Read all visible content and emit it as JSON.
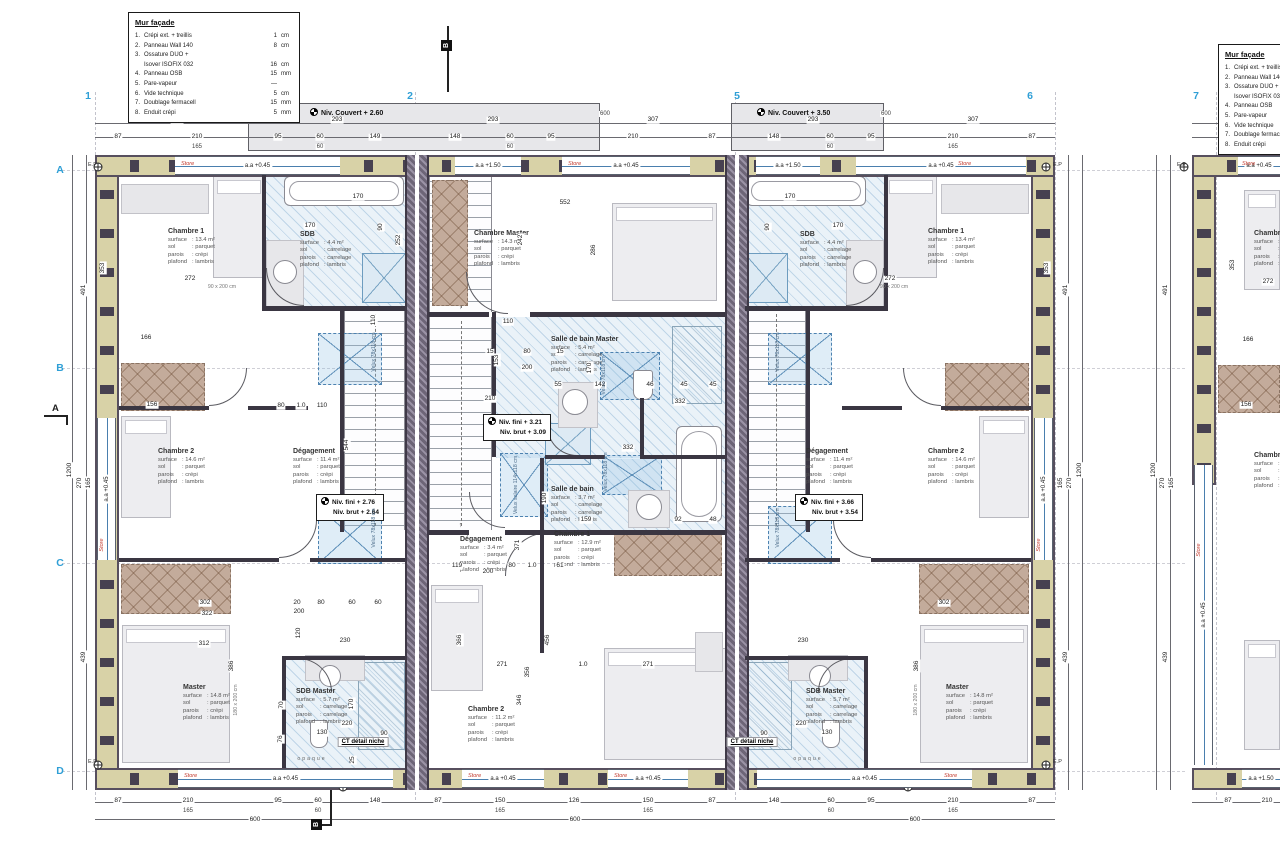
{
  "colors": {
    "grid_blue": "#2f9fd6",
    "store_red": "#c2382c",
    "wall_tan": "#d8d2a7",
    "party_gray": "#786f85",
    "bath_blue": "#eaf2f8",
    "dressing_brown": "#c3ab9b"
  },
  "legend": {
    "title": "Mur façade",
    "items": [
      {
        "n": "1.",
        "l": "Crépi ext. + treillis",
        "v": "1",
        "u": "cm"
      },
      {
        "n": "2.",
        "l": "Panneau Wall 140",
        "v": "8",
        "u": "cm"
      },
      {
        "n": "3.",
        "l": "Ossature DUO +",
        "l2": "Isover ISOFIX 032",
        "v": "16",
        "u": "cm"
      },
      {
        "n": "4.",
        "l": "Panneau OSB",
        "v": "15",
        "u": "mm"
      },
      {
        "n": "5.",
        "l": "Pare-vapeur",
        "v": "—",
        "u": ""
      },
      {
        "n": "6.",
        "l": "Vide technique",
        "v": "5",
        "u": "cm"
      },
      {
        "n": "7.",
        "l": "Doublage fermacell",
        "v": "15",
        "u": "mm"
      },
      {
        "n": "8.",
        "l": "Enduit crépi",
        "v": "5",
        "u": "mm"
      }
    ]
  },
  "grid": {
    "columns": [
      {
        "label": "1",
        "x": 88
      },
      {
        "label": "2",
        "x": 410
      },
      {
        "label": "5",
        "x": 737
      },
      {
        "label": "6",
        "x": 1030
      },
      {
        "label": "7",
        "x": 1196
      }
    ],
    "rows": [
      {
        "label": "A",
        "y": 170
      },
      {
        "label": "B",
        "y": 368
      },
      {
        "label": "C",
        "y": 563
      },
      {
        "label": "D",
        "y": 771
      }
    ]
  },
  "levels": {
    "bands": [
      {
        "label": "Niv. Couvert + 2.60",
        "x": 248,
        "y": 103,
        "w": 352,
        "h": 48,
        "lx": 62
      },
      {
        "label": "Niv. Couvert + 3.50",
        "x": 731,
        "y": 103,
        "w": 153,
        "h": 48,
        "lx": 26
      }
    ],
    "boxes": [
      {
        "l1": "Niv. fini + 2.76",
        "l2": "Niv. brut + 2.64",
        "x": 316,
        "y": 494
      },
      {
        "l1": "Niv. fini + 3.21",
        "l2": "Niv. brut + 3.09",
        "x": 483,
        "y": 414
      },
      {
        "l1": "Niv. fini + 3.66",
        "l2": "Niv. brut + 3.54",
        "x": 795,
        "y": 494
      }
    ]
  },
  "rooms": [
    {
      "id": "chambre1-left",
      "name": "Chambre 1",
      "x": 168,
      "y": 228,
      "surface": "13.4 m²",
      "sol": "parquet",
      "parois": "crépi",
      "plafond": "lambris"
    },
    {
      "id": "sdb-left",
      "name": "SDB",
      "x": 300,
      "y": 231,
      "surface": "4.4 m²",
      "sol": "carrelage",
      "parois": "carrelage",
      "plafond": "lambris"
    },
    {
      "id": "chambre2-left",
      "name": "Chambre 2",
      "x": 158,
      "y": 448,
      "surface": "14.6 m²",
      "sol": "parquet",
      "parois": "crépi",
      "plafond": "lambris"
    },
    {
      "id": "degagement-left",
      "name": "Dégagement",
      "x": 293,
      "y": 448,
      "surface": "11.4 m²",
      "sol": "parquet",
      "parois": "crépi",
      "plafond": "lambris"
    },
    {
      "id": "master-left",
      "name": "Master",
      "x": 183,
      "y": 684,
      "surface": "14.8 m²",
      "sol": "parquet",
      "parois": "crépi",
      "plafond": "lambris"
    },
    {
      "id": "sdb-master-left",
      "name": "SDB Master",
      "x": 296,
      "y": 688,
      "surface": "5.7 m²",
      "sol": "carrelage",
      "parois": "carrelage",
      "plafond": "lambris"
    },
    {
      "id": "chambre-master-center",
      "name": "Chambre Master",
      "x": 474,
      "y": 230,
      "surface": "14.3 m²",
      "sol": "parquet",
      "parois": "crépi",
      "plafond": "lambris"
    },
    {
      "id": "sdb-master-center",
      "name": "Salle de bain Master",
      "x": 551,
      "y": 336,
      "surface": "5.4 m²",
      "sol": "carrelage",
      "parois": "carrelage",
      "plafond": "lambris"
    },
    {
      "id": "sdb-center",
      "name": "Salle de bain",
      "x": 551,
      "y": 486,
      "surface": "3.7 m²",
      "sol": "carrelage",
      "parois": "carrelage",
      "plafond": "lambris"
    },
    {
      "id": "degagement-center",
      "name": "Dégagement",
      "x": 460,
      "y": 536,
      "surface": "3.4 m²",
      "sol": "parquet",
      "parois": "crépi",
      "plafond": "lambris"
    },
    {
      "id": "chambre1-center",
      "name": "Chambre 1",
      "x": 554,
      "y": 531,
      "surface": "12.9 m²",
      "sol": "parquet",
      "parois": "crépi",
      "plafond": "lambris"
    },
    {
      "id": "chambre2-center",
      "name": "Chambre 2",
      "x": 468,
      "y": 706,
      "surface": "11.2 m²",
      "sol": "parquet",
      "parois": "crépi",
      "plafond": "lambris"
    },
    {
      "id": "sdb-right",
      "name": "SDB",
      "x": 800,
      "y": 231,
      "surface": "4.4 m²",
      "sol": "carrelage",
      "parois": "carrelage",
      "plafond": "lambris"
    },
    {
      "id": "chambre1-right",
      "name": "Chambre 1",
      "x": 928,
      "y": 228,
      "surface": "13.4 m²",
      "sol": "parquet",
      "parois": "crépi",
      "plafond": "lambris"
    },
    {
      "id": "degagement-right",
      "name": "Dégagement",
      "x": 806,
      "y": 448,
      "surface": "11.4 m²",
      "sol": "parquet",
      "parois": "crépi",
      "plafond": "lambris"
    },
    {
      "id": "chambre2-right",
      "name": "Chambre 2",
      "x": 928,
      "y": 448,
      "surface": "14.6 m²",
      "sol": "parquet",
      "parois": "crépi",
      "plafond": "lambris"
    },
    {
      "id": "sdb-master-right",
      "name": "SDB Master",
      "x": 806,
      "y": 688,
      "surface": "5.7 m²",
      "sol": "carrelage",
      "parois": "carrelage",
      "plafond": "lambris"
    },
    {
      "id": "master-right",
      "name": "Master",
      "x": 946,
      "y": 684,
      "surface": "14.8 m²",
      "sol": "parquet",
      "parois": "crépi",
      "plafond": "lambris"
    },
    {
      "id": "chambre1-partial",
      "name": "Chambre 1",
      "x": 1254,
      "y": 230,
      "surface": "13.4 m²",
      "sol": "parquet",
      "parois": "crépi",
      "plafond": "lambris"
    },
    {
      "id": "chambre2-partial",
      "name": "Chambre 2",
      "x": 1254,
      "y": 452,
      "surface": "14.6 m²",
      "sol": "parquet",
      "parois": "crépi",
      "plafond": "lambris"
    }
  ],
  "room_keys": [
    "surface",
    "sol",
    "parois",
    "plafond"
  ],
  "windows": {
    "top": [
      {
        "x": 175,
        "w": 165,
        "label": "a.a +0.45"
      },
      {
        "x": 455,
        "w": 66,
        "label": "a.a +1.50"
      },
      {
        "x": 562,
        "w": 128,
        "label": "a.a +0.45"
      },
      {
        "x": 756,
        "w": 64,
        "label": "a.a +1.50"
      },
      {
        "x": 856,
        "w": 170,
        "label": "a.a +0.45"
      },
      {
        "x": 1238,
        "w": 42,
        "label": "a.a +0.45"
      }
    ],
    "bottom": [
      {
        "x": 178,
        "w": 215,
        "label": "a.a +0.45"
      },
      {
        "x": 462,
        "w": 82,
        "label": "a.a +0.45"
      },
      {
        "x": 608,
        "w": 80,
        "label": "a.a +0.45"
      },
      {
        "x": 757,
        "w": 215,
        "label": "a.a +0.45"
      },
      {
        "x": 1242,
        "w": 38,
        "label": "a.a +1.50"
      }
    ],
    "vertical": [
      {
        "x": 97,
        "y": 418,
        "h": 142,
        "label": "a.a +0.45"
      },
      {
        "x": 1034,
        "y": 418,
        "h": 142,
        "label": "a.a +0.45"
      },
      {
        "x": 1194,
        "y": 465,
        "h": 300,
        "label": "a.a +0.45"
      }
    ]
  },
  "stores": [
    [
      181,
      164
    ],
    [
      568,
      164
    ],
    [
      958,
      164
    ],
    [
      1242,
      164
    ],
    [
      184,
      776
    ],
    [
      468,
      776
    ],
    [
      614,
      776
    ],
    [
      944,
      776
    ],
    [
      102,
      545,
      "r"
    ],
    [
      1039,
      545,
      "r"
    ],
    [
      1199,
      550,
      "r"
    ]
  ],
  "store_label": "Store",
  "velux_labels": [
    {
      "t": "Velux 78x118 cm",
      "x": 374,
      "y": 352
    },
    {
      "t": "Velux 78x118 cm",
      "x": 374,
      "y": 528
    },
    {
      "t": "Velux 78x118 cm",
      "x": 604,
      "y": 375
    },
    {
      "t": "Velux solaire 114x118 cm",
      "x": 516,
      "y": 485
    },
    {
      "t": "Velux 78x118 cm",
      "x": 606,
      "y": 472
    },
    {
      "t": "Velux 78x118 cm",
      "x": 778,
      "y": 352
    },
    {
      "t": "Velux 78x118 cm",
      "x": 778,
      "y": 528
    }
  ],
  "bed_labels": [
    {
      "t": "90 x 200 cm",
      "x": 222,
      "y": 287
    },
    {
      "t": "90 x 200 cm",
      "x": 894,
      "y": 287
    },
    {
      "t": "180 x 200 cm",
      "x": 236,
      "y": 700,
      "r": 1
    },
    {
      "t": "180 x 200 cm",
      "x": 916,
      "y": 700,
      "r": 1
    }
  ],
  "callouts": {
    "ct": [
      {
        "t": "CT détail niche",
        "x": 363,
        "y": 742
      },
      {
        "t": "CT détail niche",
        "x": 752,
        "y": 742
      }
    ],
    "opaque": [
      {
        "t": "opaque",
        "x": 312,
        "y": 759
      },
      {
        "t": "opaque",
        "x": 808,
        "y": 759
      }
    ],
    "ep": [
      [
        88,
        162
      ],
      [
        88,
        759
      ],
      [
        1053,
        162
      ],
      [
        1053,
        759
      ],
      [
        1177,
        162
      ]
    ],
    "ep_label": "E.P"
  },
  "sections": [
    {
      "label": "A",
      "x": 52,
      "y": 403,
      "type": "letter"
    },
    {
      "label": "B",
      "x": 441,
      "y": 40,
      "type": "flag"
    },
    {
      "label": "B",
      "x": 311,
      "y": 819,
      "type": "flag"
    }
  ],
  "dimensions": [
    [
      "307",
      177,
      120
    ],
    [
      "293",
      337,
      120
    ],
    [
      "293",
      493,
      120
    ],
    [
      "307",
      653,
      120
    ],
    [
      "293",
      813,
      120
    ],
    [
      "307",
      973,
      120
    ],
    [
      "307",
      1258,
      120
    ],
    [
      "87",
      118,
      137
    ],
    [
      "210",
      197,
      137
    ],
    [
      "95",
      278,
      137
    ],
    [
      "60",
      320,
      137
    ],
    [
      "149",
      375,
      137
    ],
    [
      "148",
      455,
      137
    ],
    [
      "60",
      510,
      137
    ],
    [
      "95",
      551,
      137
    ],
    [
      "210",
      633,
      137
    ],
    [
      "87",
      712,
      137
    ],
    [
      "148",
      774,
      137
    ],
    [
      "60",
      830,
      137
    ],
    [
      "95",
      871,
      137
    ],
    [
      "210",
      953,
      137
    ],
    [
      "87",
      1032,
      137
    ],
    [
      "87",
      1228,
      137
    ],
    [
      "210",
      1267,
      137
    ],
    [
      "165",
      197,
      147,
      "s"
    ],
    [
      "60",
      320,
      147,
      "s"
    ],
    [
      "60",
      510,
      147,
      "s"
    ],
    [
      "60",
      830,
      147,
      "s"
    ],
    [
      "165",
      953,
      147,
      "s"
    ],
    [
      "165",
      1267,
      147,
      "s"
    ],
    [
      "600",
      605,
      114,
      "s"
    ],
    [
      "600",
      886,
      114,
      "s"
    ],
    [
      "87",
      118,
      801
    ],
    [
      "210",
      188,
      801
    ],
    [
      "95",
      278,
      801
    ],
    [
      "60",
      318,
      801
    ],
    [
      "148",
      375,
      801
    ],
    [
      "87",
      438,
      801
    ],
    [
      "150",
      500,
      801
    ],
    [
      "126",
      574,
      801
    ],
    [
      "150",
      648,
      801
    ],
    [
      "87",
      712,
      801
    ],
    [
      "148",
      774,
      801
    ],
    [
      "60",
      831,
      801
    ],
    [
      "95",
      871,
      801
    ],
    [
      "210",
      953,
      801
    ],
    [
      "87",
      1032,
      801
    ],
    [
      "87",
      1228,
      801
    ],
    [
      "210",
      1267,
      801
    ],
    [
      "165",
      188,
      811,
      "s"
    ],
    [
      "60",
      318,
      811,
      "s"
    ],
    [
      "165",
      500,
      811,
      "s"
    ],
    [
      "165",
      648,
      811,
      "s"
    ],
    [
      "60",
      831,
      811,
      "s"
    ],
    [
      "165",
      953,
      811,
      "s"
    ],
    [
      "600",
      255,
      820
    ],
    [
      "600",
      575,
      820
    ],
    [
      "600",
      915,
      820
    ],
    [
      "491",
      84,
      290,
      "r"
    ],
    [
      "1200",
      70,
      470,
      "r"
    ],
    [
      "270",
      80,
      483,
      "r"
    ],
    [
      "165",
      89,
      483,
      "r"
    ],
    [
      "439",
      84,
      657,
      "r"
    ],
    [
      "491",
      1066,
      290,
      "r"
    ],
    [
      "1200",
      1080,
      470,
      "r"
    ],
    [
      "270",
      1070,
      483,
      "r"
    ],
    [
      "165",
      1061,
      483,
      "r"
    ],
    [
      "439",
      1066,
      657,
      "r"
    ],
    [
      "491",
      1166,
      290,
      "r"
    ],
    [
      "1200",
      1154,
      470,
      "r"
    ],
    [
      "270",
      1163,
      483,
      "r"
    ],
    [
      "165",
      1172,
      483,
      "r"
    ],
    [
      "439",
      1166,
      657,
      "r"
    ],
    [
      "170",
      310,
      226
    ],
    [
      "90",
      381,
      227,
      "r"
    ],
    [
      "170",
      358,
      197
    ],
    [
      "252",
      399,
      240,
      "r"
    ],
    [
      "272",
      190,
      279
    ],
    [
      "166",
      146,
      338
    ],
    [
      "110",
      374,
      320,
      "r"
    ],
    [
      "156",
      152,
      405
    ],
    [
      "80",
      281,
      406
    ],
    [
      "1.0",
      301,
      406
    ],
    [
      "110",
      322,
      406
    ],
    [
      "544",
      347,
      445,
      "r"
    ],
    [
      "302",
      205,
      603
    ],
    [
      "322",
      207,
      614
    ],
    [
      "312",
      204,
      644
    ],
    [
      "386",
      232,
      666,
      "r"
    ],
    [
      "230",
      345,
      641
    ],
    [
      "170",
      352,
      704,
      "r"
    ],
    [
      "220",
      347,
      724
    ],
    [
      "130",
      322,
      733
    ],
    [
      "90",
      384,
      734
    ],
    [
      "20",
      297,
      603
    ],
    [
      "80",
      321,
      603
    ],
    [
      "60",
      352,
      603
    ],
    [
      "60",
      378,
      603
    ],
    [
      "200",
      299,
      612
    ],
    [
      "120",
      299,
      633,
      "r"
    ],
    [
      "70",
      282,
      705,
      "r"
    ],
    [
      "76",
      281,
      739,
      "r"
    ],
    [
      "25",
      353,
      760,
      "r"
    ],
    [
      "552",
      565,
      203
    ],
    [
      "286",
      594,
      250,
      "r"
    ],
    [
      "242",
      521,
      240,
      "r"
    ],
    [
      "110",
      508,
      322
    ],
    [
      "153",
      497,
      360,
      "r"
    ],
    [
      "15",
      490,
      352
    ],
    [
      "80",
      527,
      352
    ],
    [
      "15",
      560,
      352
    ],
    [
      "200",
      527,
      368
    ],
    [
      "210",
      490,
      399
    ],
    [
      "55",
      558,
      385
    ],
    [
      "142",
      600,
      385
    ],
    [
      "46",
      650,
      385
    ],
    [
      "45",
      684,
      385
    ],
    [
      "45",
      713,
      385
    ],
    [
      "332",
      680,
      402
    ],
    [
      "170",
      590,
      368,
      "r"
    ],
    [
      "332",
      628,
      448
    ],
    [
      "190",
      545,
      498,
      "r"
    ],
    [
      "159",
      586,
      520
    ],
    [
      "92",
      678,
      520
    ],
    [
      "48",
      713,
      520
    ],
    [
      "119",
      457,
      566
    ],
    [
      "80",
      512,
      566
    ],
    [
      "1.0",
      532,
      566
    ],
    [
      "61",
      560,
      566
    ],
    [
      "200",
      488,
      572
    ],
    [
      "271",
      502,
      665
    ],
    [
      "1.0",
      583,
      665
    ],
    [
      "271",
      648,
      665
    ],
    [
      "456",
      548,
      640,
      "r"
    ],
    [
      "356",
      528,
      672,
      "r"
    ],
    [
      "366",
      460,
      640,
      "r"
    ],
    [
      "272",
      890,
      279
    ],
    [
      "170",
      838,
      226
    ],
    [
      "170",
      790,
      197
    ],
    [
      "90",
      768,
      227,
      "r"
    ],
    [
      "302",
      944,
      603
    ],
    [
      "230",
      803,
      641
    ],
    [
      "130",
      827,
      733
    ],
    [
      "90",
      764,
      734
    ],
    [
      "220",
      801,
      724
    ],
    [
      "386",
      917,
      666,
      "r"
    ],
    [
      "353",
      103,
      268,
      "r"
    ],
    [
      "353",
      1047,
      268,
      "r"
    ],
    [
      "353",
      1233,
      265,
      "r"
    ],
    [
      "272",
      1268,
      282
    ],
    [
      "166",
      1248,
      340
    ],
    [
      "156",
      1246,
      405
    ],
    [
      "371",
      518,
      545,
      "r"
    ],
    [
      "346",
      520,
      700,
      "r"
    ]
  ]
}
